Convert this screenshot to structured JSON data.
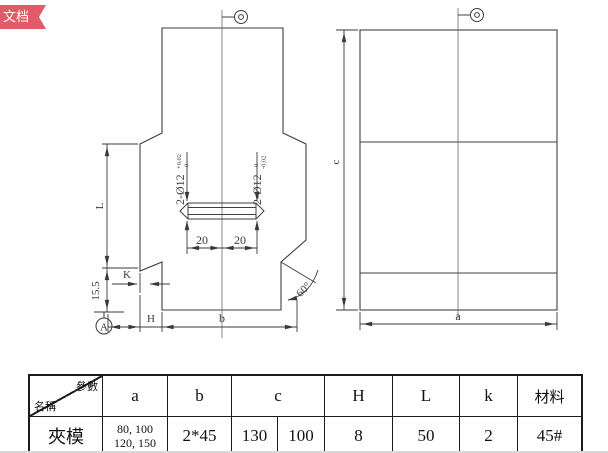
{
  "badge": {
    "label": "文档"
  },
  "front": {
    "hole_left": "2-Ø12",
    "hole_left_sup": "+0.02",
    "hole_left_sub": "0",
    "hole_right": "2-Ø12",
    "hole_right_sup": "0",
    "hole_right_sub": "-0.02",
    "dim_20_left": "20",
    "dim_20_right": "20",
    "dim_L": "L",
    "dim_155": "15.5",
    "dim_K": "K",
    "dim_H": "H",
    "dim_b": "b",
    "angle_60": "60°",
    "datum_A": "A"
  },
  "side": {
    "dim_c": "c",
    "dim_a": "a"
  },
  "table": {
    "corner": {
      "top_right": "參數",
      "bottom_left": "名稱"
    },
    "headers": {
      "a": "a",
      "b": "b",
      "c": "c",
      "H": "H",
      "L": "L",
      "k": "k",
      "material": "材料"
    },
    "row": {
      "name": "夾模",
      "a_line1": "80, 100",
      "a_line2": "120, 150",
      "b": "2*45",
      "c1": "130",
      "c2": "100",
      "H": "8",
      "L": "50",
      "k": "2",
      "material": "45#"
    }
  }
}
